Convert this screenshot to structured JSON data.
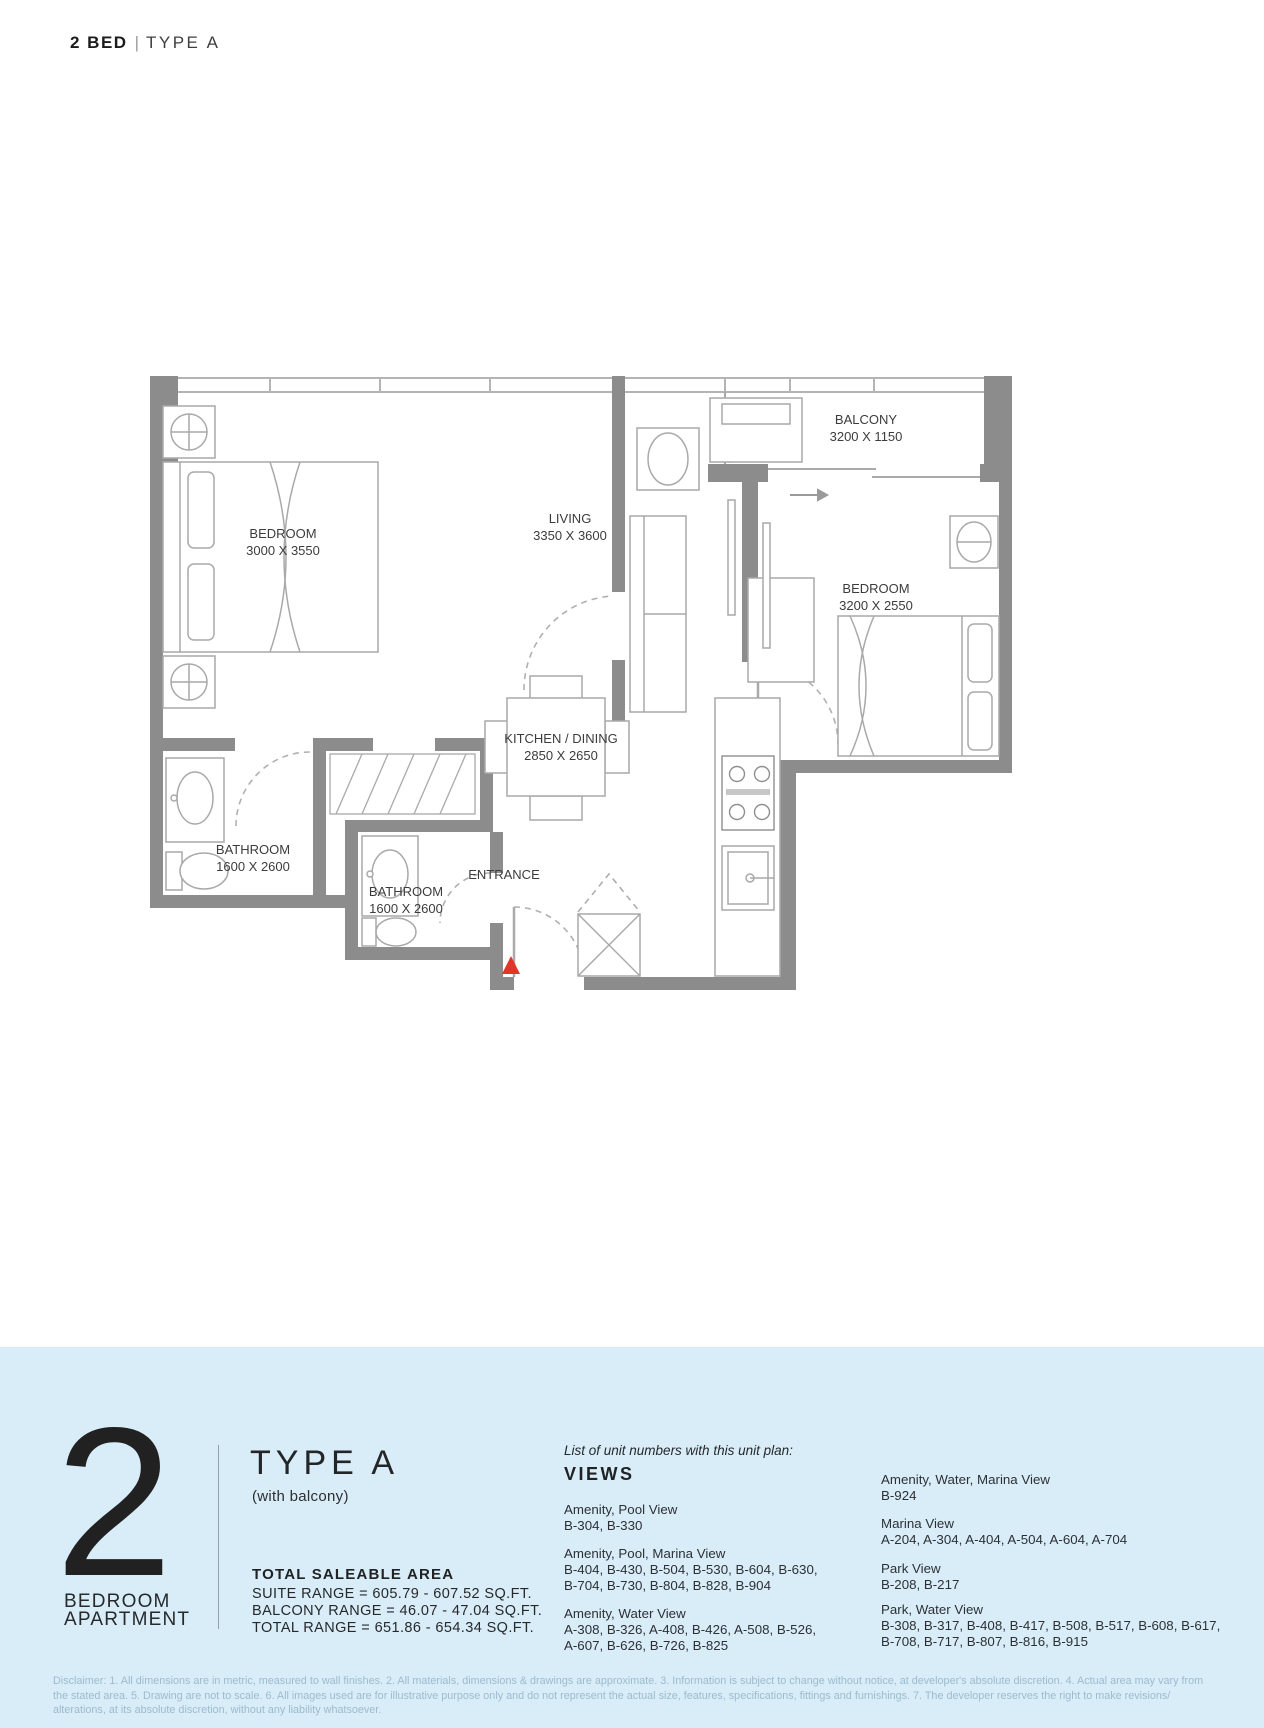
{
  "header": {
    "title_primary": "2 BED",
    "title_divider": "|",
    "title_secondary": "TYPE A"
  },
  "plan": {
    "labels": {
      "bedroom1_name": "BEDROOM",
      "bedroom1_dims": "3000 X 3550",
      "living_name": "LIVING",
      "living_dims": "3350 X 3600",
      "balcony_name": "BALCONY",
      "balcony_dims": "3200 X 1150",
      "bedroom2_name": "BEDROOM",
      "bedroom2_dims": "3200 X 2550",
      "kitchen_name": "KITCHEN / DINING",
      "kitchen_dims": "2850 X 2650",
      "bathroom1_name": "BATHROOM",
      "bathroom1_dims": "1600 X 2600",
      "bathroom2_name": "BATHROOM",
      "bathroom2_dims": "1600 X 2600",
      "entrance": "ENTRANCE"
    },
    "colors": {
      "wall": "#8c8c8c",
      "line": "#a9a9a9",
      "entrance_marker": "#e0352b"
    }
  },
  "summary": {
    "unit_number": "2",
    "unit_type_lines": [
      "BEDROOM",
      "APARTMENT"
    ],
    "type_title": "TYPE A",
    "type_subtitle": "(with balcony)",
    "area_heading": "TOTAL SALEABLE AREA",
    "area_lines": [
      "SUITE RANGE = 605.79 - 607.52 SQ.FT.",
      "BALCONY RANGE = 46.07 - 47.04 SQ.FT.",
      "TOTAL RANGE = 651.86 - 654.34 SQ.FT."
    ],
    "panel_bg": "#d9edf9"
  },
  "views": {
    "intro": "List of unit numbers with this unit plan:",
    "heading": "VIEWS",
    "left_groups": [
      {
        "label": "Amenity, Pool View",
        "lines": [
          "B-304, B-330"
        ]
      },
      {
        "label": "Amenity, Pool, Marina View",
        "lines": [
          "B-404, B-430, B-504, B-530, B-604, B-630,",
          "B-704, B-730, B-804, B-828, B-904"
        ]
      },
      {
        "label": "Amenity, Water View",
        "lines": [
          "A-308, B-326, A-408, B-426, A-508, B-526,",
          "A-607, B-626, B-726, B-825"
        ]
      }
    ],
    "right_groups": [
      {
        "label": "Amenity, Water, Marina View",
        "lines": [
          "B-924"
        ]
      },
      {
        "label": "Marina View",
        "lines": [
          "A-204, A-304, A-404, A-504, A-604, A-704"
        ]
      },
      {
        "label": "Park View",
        "lines": [
          "B-208, B-217"
        ]
      },
      {
        "label": "Park, Water View",
        "lines": [
          "B-308, B-317, B-408, B-417, B-508, B-517, B-608, B-617,",
          "B-708, B-717, B-807, B-816, B-915"
        ]
      }
    ]
  },
  "disclaimer": "Disclaimer: 1. All dimensions are in metric, measured to wall finishes. 2. All materials, dimensions & drawings are approximate. 3. Information is subject to change without notice, at developer's absolute discretion. 4. Actual area may vary from the stated area. 5. Drawing are not to scale. 6. All images used are for illustrative purpose only and do not represent the actual size, features, specifications, fittings and furnishings. 7. The developer reserves the right to make revisions/ alterations, at its absolute discretion, without any liability whatsoever."
}
